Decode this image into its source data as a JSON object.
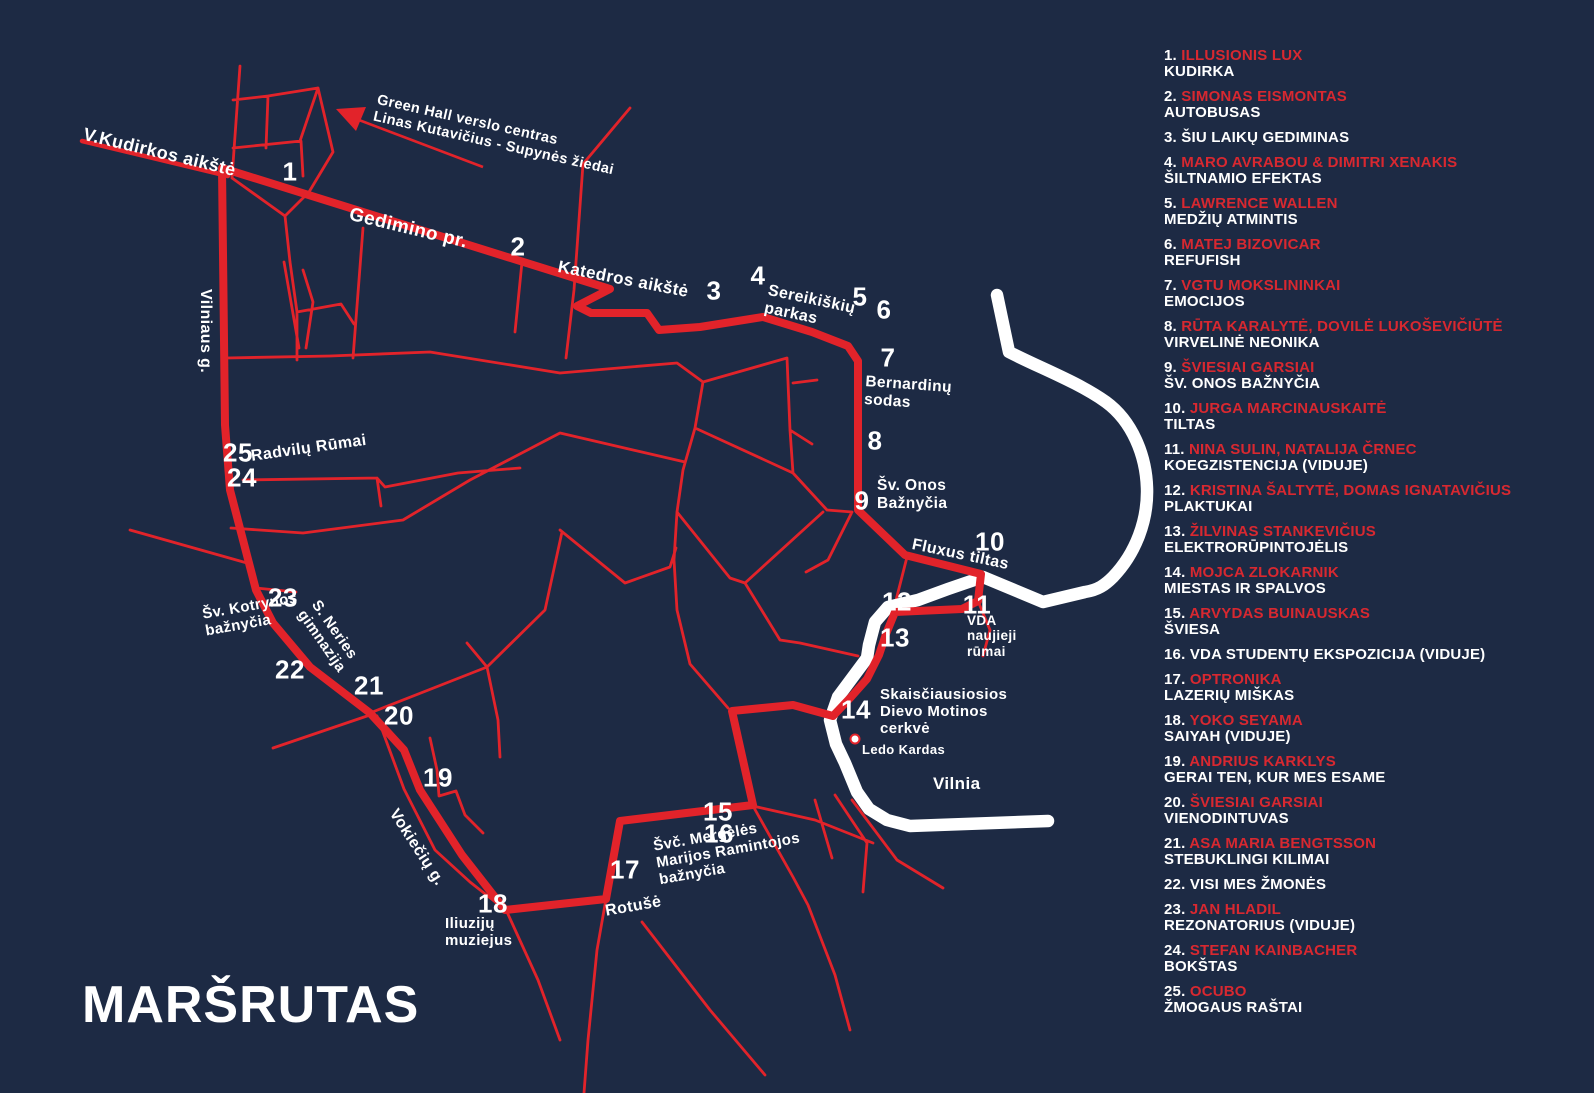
{
  "title": "MARŠRUTAS",
  "colors": {
    "background": "#1d2a44",
    "route_red": "#e2232a",
    "text_red": "#d82830",
    "river_white": "#ffffff"
  },
  "map_labels": [
    {
      "id": "v-kudirkos-aikste",
      "text": "V.Kudirkos aikštė",
      "x": 86,
      "y": 124,
      "rot": 13.5,
      "fs": 18
    },
    {
      "id": "gedimino-pr",
      "text": "Gedimino pr.",
      "x": 352,
      "y": 204,
      "rot": 13.5,
      "fs": 19
    },
    {
      "id": "katedros-aikste",
      "text": "Katedros aikštė",
      "x": 560,
      "y": 257,
      "rot": 11,
      "fs": 17
    },
    {
      "id": "sereikiskiu-parkas",
      "text": "Sereikiškių\nparkas",
      "x": 770,
      "y": 282,
      "rot": 12,
      "fs": 16
    },
    {
      "id": "bernardinu-sodas",
      "text": "Bernardinų\nsodas",
      "x": 866,
      "y": 373,
      "rot": 4,
      "fs": 15.5
    },
    {
      "id": "sv-onos-baznycia",
      "text": "Šv. Onos\nBažnyčia",
      "x": 877,
      "y": 477,
      "rot": 0,
      "fs": 15.5
    },
    {
      "id": "fluxus-tiltas",
      "text": "Fluxus tiltas",
      "x": 914,
      "y": 536,
      "rot": 12,
      "fs": 16
    },
    {
      "id": "vda-naujieji-rumai",
      "text": "VDA\nnaujieji\nrūmai",
      "x": 967,
      "y": 613,
      "rot": 0,
      "fs": 13.5
    },
    {
      "id": "skaisciausiosios-cerkve",
      "text": "Skaisčiausiosios\nDievo Motinos\ncerkvė",
      "x": 880,
      "y": 686,
      "rot": 0,
      "fs": 15
    },
    {
      "id": "ledo-kardas",
      "text": "Ledo Kardas",
      "x": 862,
      "y": 743,
      "rot": 0,
      "fs": 13
    },
    {
      "id": "vilnia",
      "text": "Vilnia",
      "x": 933,
      "y": 774,
      "rot": 0,
      "fs": 17
    },
    {
      "id": "svc-mergeles-baznycia",
      "text": "Švč. Mergelės\nMarijos Ramintojos\nbažnyčia",
      "x": 652,
      "y": 838,
      "rot": -10,
      "fs": 15
    },
    {
      "id": "rotuse",
      "text": "Rotušė",
      "x": 604,
      "y": 903,
      "rot": -10,
      "fs": 16
    },
    {
      "id": "iliuziju-muziejus",
      "text": "Iliuzijų\nmuziejus",
      "x": 445,
      "y": 915,
      "rot": 0,
      "fs": 15
    },
    {
      "id": "vokieciu-g",
      "text": "Vokiečių g.",
      "x": 400,
      "y": 806,
      "rot": 57,
      "fs": 16
    },
    {
      "id": "s-neries-gimnazija",
      "text": "S. Neries\ngimnazija",
      "x": 322,
      "y": 597,
      "rot": 55,
      "fs": 15
    },
    {
      "id": "sv-kotrynos-baznycia",
      "text": "Šv. Kotrynos\nbažnyčia",
      "x": 201,
      "y": 606,
      "rot": -10,
      "fs": 15
    },
    {
      "id": "radvilu-rumai",
      "text": "Radvilų Rūmai",
      "x": 250,
      "y": 448,
      "rot": -8,
      "fs": 16
    },
    {
      "id": "vilniaus-g",
      "text": "Vilniaus g.",
      "x": 214,
      "y": 289,
      "rot": 90,
      "fs": 16
    },
    {
      "id": "green-hall-note",
      "text": "Green Hall verslo centras\nLinas Kutavičius - Supynės žiedai",
      "x": 379,
      "y": 92,
      "rot": 12.7,
      "fs": 14.5
    }
  ],
  "stops": [
    {
      "n": "1",
      "x": 290,
      "y": 172
    },
    {
      "n": "2",
      "x": 518,
      "y": 247
    },
    {
      "n": "3",
      "x": 714,
      "y": 291
    },
    {
      "n": "4",
      "x": 758,
      "y": 276
    },
    {
      "n": "5",
      "x": 860,
      "y": 297
    },
    {
      "n": "6",
      "x": 884,
      "y": 310
    },
    {
      "n": "7",
      "x": 888,
      "y": 358
    },
    {
      "n": "8",
      "x": 875,
      "y": 441
    },
    {
      "n": "9",
      "x": 862,
      "y": 501
    },
    {
      "n": "10",
      "x": 990,
      "y": 542
    },
    {
      "n": "11",
      "x": 977,
      "y": 605
    },
    {
      "n": "12",
      "x": 897,
      "y": 602
    },
    {
      "n": "13",
      "x": 895,
      "y": 638
    },
    {
      "n": "14",
      "x": 856,
      "y": 710
    },
    {
      "n": "15",
      "x": 718,
      "y": 812
    },
    {
      "n": "16",
      "x": 719,
      "y": 834
    },
    {
      "n": "17",
      "x": 625,
      "y": 870
    },
    {
      "n": "18",
      "x": 493,
      "y": 904
    },
    {
      "n": "19",
      "x": 438,
      "y": 778
    },
    {
      "n": "20",
      "x": 399,
      "y": 716
    },
    {
      "n": "21",
      "x": 369,
      "y": 686
    },
    {
      "n": "22",
      "x": 290,
      "y": 670
    },
    {
      "n": "23",
      "x": 283,
      "y": 598
    },
    {
      "n": "24",
      "x": 242,
      "y": 478
    },
    {
      "n": "25",
      "x": 238,
      "y": 453
    }
  ],
  "legend": [
    {
      "num": "1.",
      "artist": "ILLUSIONIS LUX",
      "work": "KUDIRKA"
    },
    {
      "num": "2.",
      "artist": "SIMONAS EISMONTAS",
      "work": "AUTOBUSAS"
    },
    {
      "num": "3.",
      "artist": "",
      "work": "ŠIU LAIKŲ GEDIMINAS"
    },
    {
      "num": "4.",
      "artist": "MARO AVRABOU & DIMITRI XENAKIS",
      "work": "ŠILTNAMIO EFEKTAS"
    },
    {
      "num": "5.",
      "artist": "LAWRENCE WALLEN",
      "work": "MEDŽIŲ ATMINTIS"
    },
    {
      "num": "6.",
      "artist": "MATEJ BIZOVICAR",
      "work": "REFUFISH"
    },
    {
      "num": "7.",
      "artist": "VGTU MOKSLININKAI",
      "work": "EMOCIJOS"
    },
    {
      "num": "8.",
      "artist": "RŪTA KARALYTĖ, DOVILĖ LUKOŠEVIČIŪTĖ",
      "work": "VIRVELINĖ NEONIKA"
    },
    {
      "num": "9.",
      "artist": "ŠVIESIAI GARSIAI",
      "work": "ŠV. ONOS BAŽNYČIA"
    },
    {
      "num": "10.",
      "artist": "JURGA MARCINAUSKAITĖ",
      "work": "TILTAS"
    },
    {
      "num": "11.",
      "artist": "NINA SULIN, NATALIJA ČRNEC",
      "work": "KOEGZISTENCIJA  (VIDUJE)"
    },
    {
      "num": "12.",
      "artist": "KRISTINA ŠALTYTĖ, DOMAS IGNATAVIČIUS",
      "work": "PLAKTUKAI"
    },
    {
      "num": "13.",
      "artist": "ŽILVINAS STANKEVIČIUS",
      "work": "ELEKTRORŪPINTOJĖLIS"
    },
    {
      "num": "14.",
      "artist": "MOJCA ZLOKARNIK",
      "work": "MIESTAS IR SPALVOS"
    },
    {
      "num": "15.",
      "artist": "ARVYDAS BUINAUSKAS",
      "work": "ŠVIESA"
    },
    {
      "num": "16.",
      "artist": "",
      "work": "VDA STUDENTŲ EKSPOZICIJA  (VIDUJE)"
    },
    {
      "num": "17.",
      "artist": "OPTRONIKA",
      "work": "LAZERIŲ MIŠKAS"
    },
    {
      "num": "18.",
      "artist": "YOKO SEYAMA",
      "work": "SAIYAH  (VIDUJE)"
    },
    {
      "num": "19.",
      "artist": "ANDRIUS KARKLYS",
      "work": "GERAI TEN, KUR MES ESAME"
    },
    {
      "num": "20.",
      "artist": "ŠVIESIAI GARSIAI",
      "work": "VIENODINTUVAS"
    },
    {
      "num": "21.",
      "artist": "ASA MARIA BENGTSSON",
      "work": "STEBUKLINGI KILIMAI"
    },
    {
      "num": "22.",
      "artist": "",
      "work": "VISI MES ŽMONĖS"
    },
    {
      "num": "23.",
      "artist": "JAN HLADIL",
      "work": "REZONATORIUS (VIDUJE)"
    },
    {
      "num": "24.",
      "artist": "STEFAN KAINBACHER",
      "work": "BOKŠTAS"
    },
    {
      "num": "25.",
      "artist": "OCUBO",
      "work": "ŽMOGAUS RAŠTAI"
    }
  ]
}
